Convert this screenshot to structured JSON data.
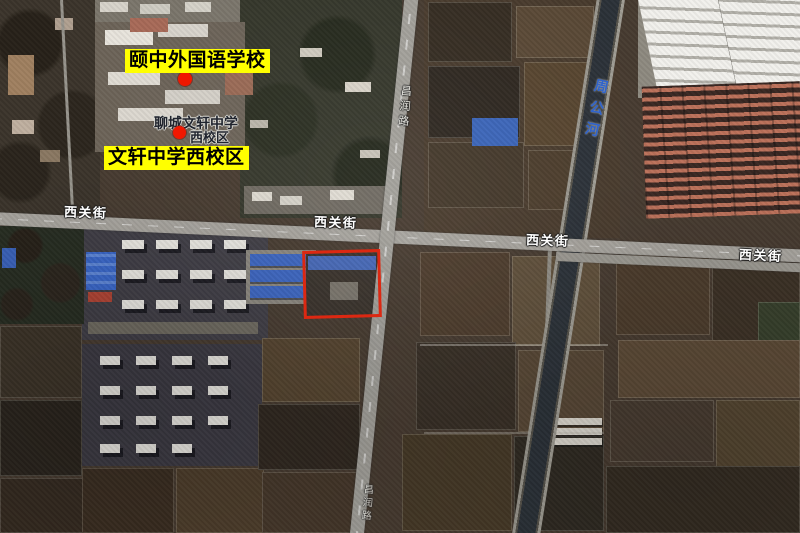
{
  "map_type": "satellite-annotated",
  "annotations": {
    "labels": [
      {
        "text": "颐中外国语学校"
      },
      {
        "text": "文轩中学西校区"
      }
    ],
    "markers": [
      {
        "name": "school-marker-top"
      },
      {
        "name": "school-marker-poi"
      }
    ]
  },
  "poi": {
    "line1": "聊城文轩中学",
    "line2": "西校区"
  },
  "map_labels": {
    "street": "西关街",
    "vertical_road": "昌润路",
    "river": "周公河"
  },
  "colors": {
    "label_bg": "#ffff00",
    "label_text": "#000000",
    "marker_red": "#f01800",
    "highlight_red": "#dc2812",
    "street_text": "#ffffff",
    "river_text": "#2f63cc"
  }
}
